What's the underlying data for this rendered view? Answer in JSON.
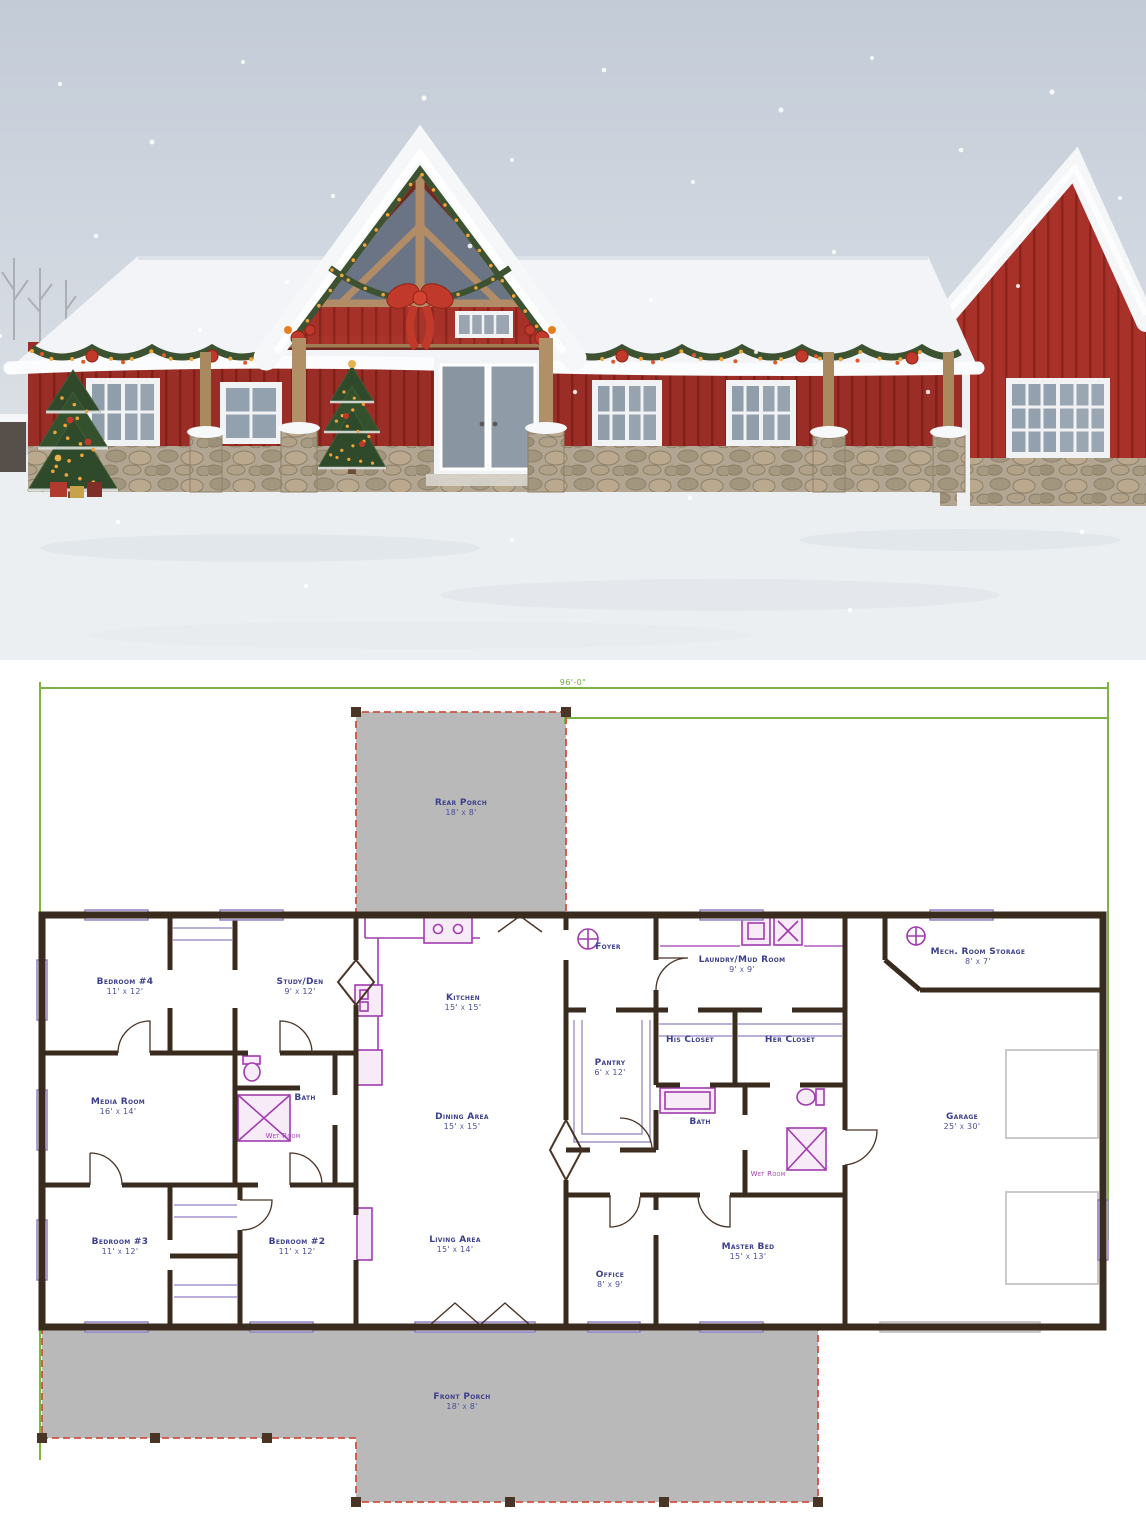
{
  "image_title": "Barndominium with christmas decorations and floor plan",
  "photo": {
    "colors": {
      "barn_red": "#a83129",
      "batten_shadow": "#8b241c",
      "roof_snow": "#f2f4f7",
      "sky": "#c9d1db",
      "stone": "#b2a693",
      "timber": "#b08d6a",
      "garland_green": "#3c5230",
      "light_orange": "#f0a43c",
      "bow_red": "#c0392b",
      "snow_ground": "#eceff1"
    }
  },
  "plan": {
    "dimension_top": "96'-0\"",
    "colors": {
      "wall": "#3a2b1f",
      "label_text": "#3c3f8e",
      "fixture_purple": "#a23bb0",
      "window_purple": "#9183c6",
      "porch_fill": "#b9b9b9",
      "porch_dash_red": "#cf5240",
      "dimension_green": "#7cb342"
    },
    "rooms": [
      {
        "id": "rear-porch",
        "name": "Rear Porch",
        "dims": "18' x 8'"
      },
      {
        "id": "bedroom-4",
        "name": "Bedroom #4",
        "dims": "11' x 12'"
      },
      {
        "id": "study-den",
        "name": "Study/Den",
        "dims": "9' x 12'"
      },
      {
        "id": "kitchen",
        "name": "Kitchen",
        "dims": "15' x 15'"
      },
      {
        "id": "foyer",
        "name": "Foyer",
        "dims": ""
      },
      {
        "id": "laundry-mud-room",
        "name": "Laundry/Mud Room",
        "dims": "9' x 9'"
      },
      {
        "id": "mech-room-storage",
        "name": "Mech. Room Storage",
        "dims": "8' x 7'"
      },
      {
        "id": "media-room",
        "name": "Media Room",
        "dims": "16' x 14'"
      },
      {
        "id": "bath-left",
        "name": "Bath",
        "dims": ""
      },
      {
        "id": "wet-room-left",
        "name": "Wet Room",
        "dims": ""
      },
      {
        "id": "dining-area",
        "name": "Dining Area",
        "dims": "15' x 15'"
      },
      {
        "id": "pantry",
        "name": "Pantry",
        "dims": "6' x 12'"
      },
      {
        "id": "his-closet",
        "name": "His Closet",
        "dims": ""
      },
      {
        "id": "her-closet",
        "name": "Her Closet",
        "dims": ""
      },
      {
        "id": "bath-right",
        "name": "Bath",
        "dims": ""
      },
      {
        "id": "wet-room-right",
        "name": "Wet Room",
        "dims": ""
      },
      {
        "id": "garage",
        "name": "Garage",
        "dims": "25' x 30'"
      },
      {
        "id": "bedroom-3",
        "name": "Bedroom #3",
        "dims": "11' x 12'"
      },
      {
        "id": "bedroom-2",
        "name": "Bedroom #2",
        "dims": "11' x 12'"
      },
      {
        "id": "living-area",
        "name": "Living Area",
        "dims": "15' x 14'"
      },
      {
        "id": "office",
        "name": "Office",
        "dims": "8' x 9'"
      },
      {
        "id": "master-bed",
        "name": "Master Bed",
        "dims": "15' x 13'"
      },
      {
        "id": "front-porch",
        "name": "Front Porch",
        "dims": "18' x 8'"
      }
    ]
  }
}
